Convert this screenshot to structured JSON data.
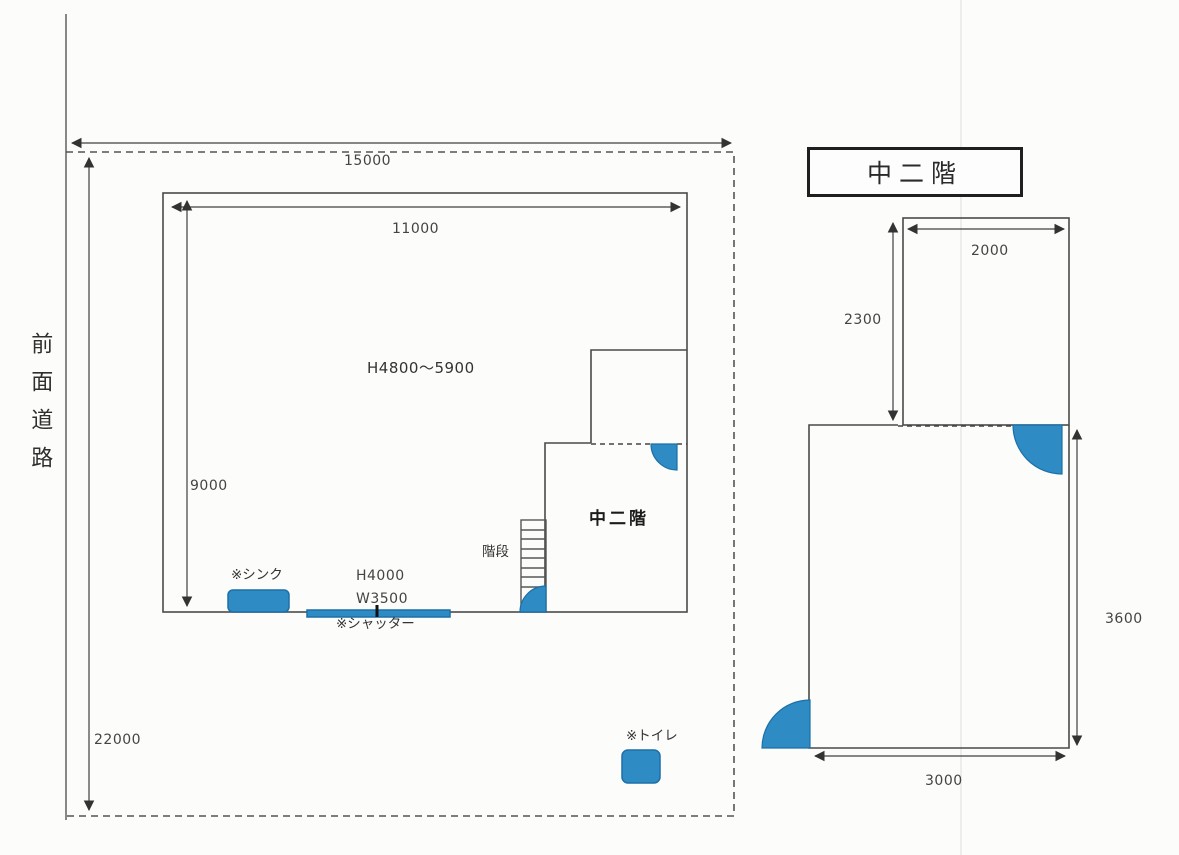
{
  "colors": {
    "door_blue": "#2E8BC4",
    "door_blue_border": "#1C6FA8",
    "line_dark": "#4A4A4A"
  },
  "site_plan": {
    "road_label": "前面道路",
    "site_width": "15000",
    "site_depth": "22000",
    "building_width": "11000",
    "building_depth": "9000",
    "ceiling_height": "H4800〜5900",
    "mezzanine_label": "中二階",
    "stairs_label": "階段",
    "sink_label": "※シンク",
    "shutter_height": "H4000",
    "shutter_width": "W3500",
    "shutter_label": "※シャッター",
    "toilet_label": "※トイレ"
  },
  "mezzanine_plan": {
    "title": "中二階",
    "upper_width": "2000",
    "upper_height": "2300",
    "lower_width": "3000",
    "lower_height": "3600"
  }
}
